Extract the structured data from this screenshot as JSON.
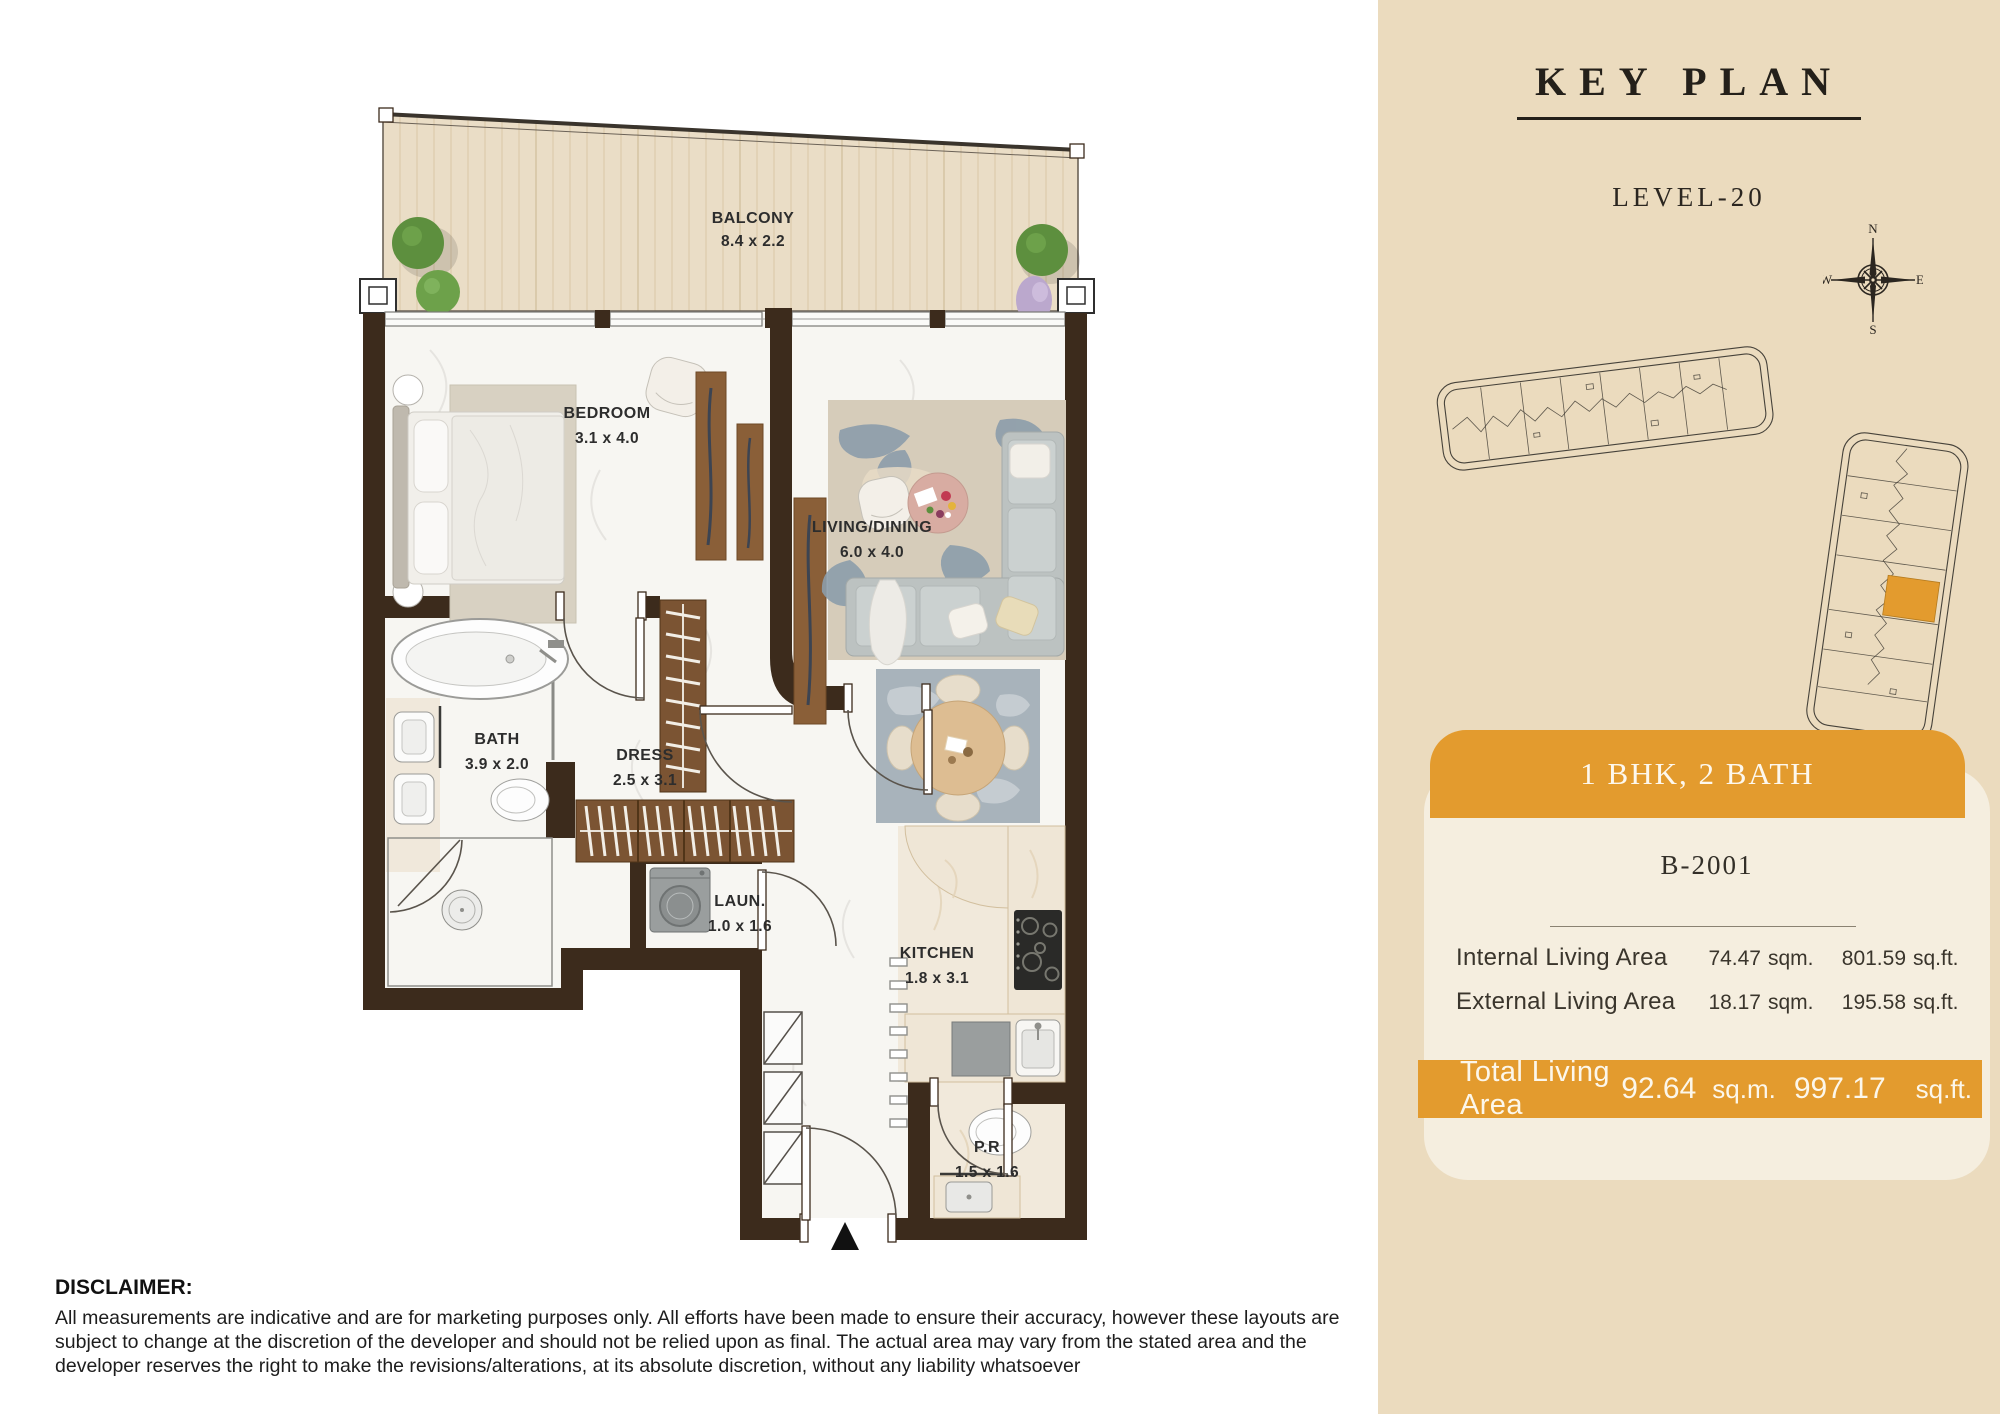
{
  "sidebar": {
    "title": "KEY PLAN",
    "level": "LEVEL-20",
    "compass": {
      "n": "N",
      "e": "E",
      "s": "S",
      "w": "W"
    },
    "card": {
      "type_label": "1 BHK, 2 BATH",
      "unit_number": "B-2001",
      "rows": [
        {
          "label": "Internal Living Area",
          "sqm": "74.47",
          "sqm_unit": "sqm.",
          "sqft": "801.59",
          "sqft_unit": "sq.ft."
        },
        {
          "label": "External Living Area",
          "sqm": "18.17",
          "sqm_unit": "sqm.",
          "sqft": "195.58",
          "sqft_unit": "sq.ft."
        }
      ],
      "total": {
        "label": "Total Living Area",
        "sqm": "92.64",
        "sqm_unit": "sq.m.",
        "sqft": "997.17",
        "sqft_unit": "sq.ft."
      }
    }
  },
  "plan": {
    "rooms": [
      {
        "name": "BALCONY",
        "dims": "8.4 x 2.2"
      },
      {
        "name": "BEDROOM",
        "dims": "3.1 x 4.0"
      },
      {
        "name": "LIVING/DINING",
        "dims": "6.0 x 4.0"
      },
      {
        "name": "BATH",
        "dims": "3.9 x 2.0"
      },
      {
        "name": "DRESS",
        "dims": "2.5 x 3.1"
      },
      {
        "name": "LAUN.",
        "dims": "1.0 x 1.6"
      },
      {
        "name": "KITCHEN",
        "dims": "1.8 x 3.1"
      },
      {
        "name": "P.R",
        "dims": "1.5 x 1.6"
      }
    ]
  },
  "disclaimer": {
    "heading": "DISCLAIMER:",
    "body": "All measurements are indicative and are for marketing purposes only. All efforts have been made to ensure their accuracy, however these layouts are subject to change at the discretion of the developer and should not be relied upon as final. The actual area may vary from the stated area and the developer reserves the right to make the revisions/alterations, at its absolute discretion, without any liability whatsoever"
  },
  "colors": {
    "accent": "#E39B2E",
    "sidebar_bg": "#EBDBBE",
    "card_bg": "#F5EEDF",
    "wall": "#3C2B1C"
  }
}
